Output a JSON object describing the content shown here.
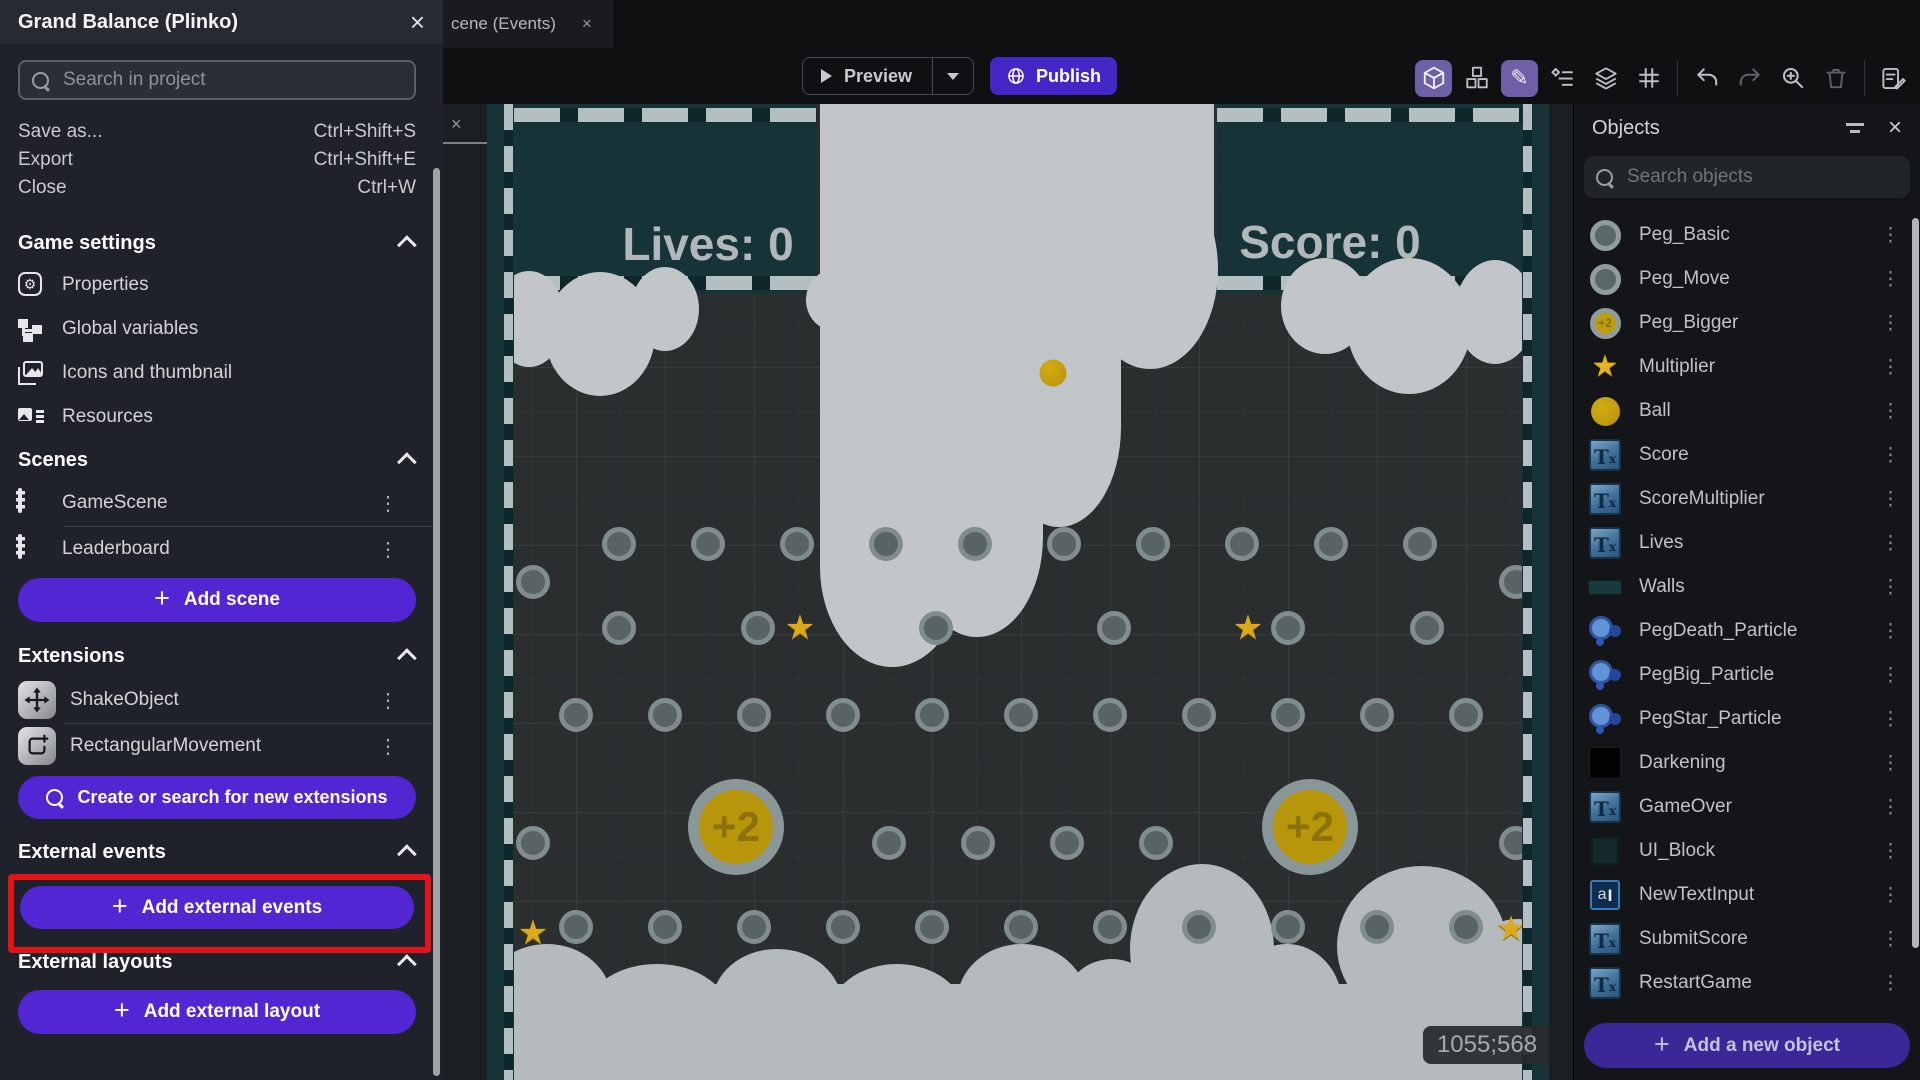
{
  "colors": {
    "accent_purple": "#5326d4",
    "publish_purple": "#4526c6",
    "highlight_red": "#e51414",
    "teal_block": "#163438",
    "gold": "#c9a40b",
    "cloud": "#c2c6c9"
  },
  "drawer": {
    "title": "Grand Balance (Plinko)",
    "close_icon": "×",
    "search_placeholder": "Search in project",
    "menu_items": [
      {
        "label": "Save as...",
        "shortcut": "Ctrl+Shift+S"
      },
      {
        "label": "Export",
        "shortcut": "Ctrl+Shift+E"
      },
      {
        "label": "Close",
        "shortcut": "Ctrl+W"
      }
    ],
    "game_settings": {
      "title": "Game settings",
      "items": [
        "Properties",
        "Global variables",
        "Icons and thumbnail",
        "Resources"
      ]
    },
    "scenes": {
      "title": "Scenes",
      "items": [
        "GameScene",
        "Leaderboard"
      ],
      "add_button": "Add scene"
    },
    "extensions": {
      "title": "Extensions",
      "items": [
        "ShakeObject",
        "RectangularMovement"
      ],
      "search_button": "Create or search for new extensions"
    },
    "external_events": {
      "title": "External events",
      "add_button": "Add external events"
    },
    "external_layouts": {
      "title": "External layouts",
      "add_button": "Add external layout"
    },
    "kebab_icon": "⋮"
  },
  "tab_bar": {
    "active_tab": "cene (Events)",
    "close_icon": "×"
  },
  "toolbar": {
    "preview_label": "Preview",
    "publish_label": "Publish"
  },
  "canvas": {
    "lives_text": "Lives: 0",
    "score_text": "Score: 0",
    "multiplier_text": "x25%",
    "cursor_coordinates": "1055;568",
    "scene": {
      "pegs": [
        [
          132,
          440
        ],
        [
          221,
          440
        ],
        [
          310,
          440
        ],
        [
          399,
          440
        ],
        [
          488,
          440
        ],
        [
          577,
          440
        ],
        [
          666,
          440
        ],
        [
          755,
          440
        ],
        [
          844,
          440
        ],
        [
          933,
          440
        ],
        [
          46,
          478
        ],
        [
          1029,
          478
        ],
        [
          132,
          524
        ],
        [
          271,
          524
        ],
        [
          449,
          524
        ],
        [
          627,
          524
        ],
        [
          801,
          524
        ],
        [
          940,
          524
        ],
        [
          89,
          611
        ],
        [
          178,
          611
        ],
        [
          267,
          611
        ],
        [
          356,
          611
        ],
        [
          445,
          611
        ],
        [
          534,
          611
        ],
        [
          623,
          611
        ],
        [
          712,
          611
        ],
        [
          801,
          611
        ],
        [
          890,
          611
        ],
        [
          979,
          611
        ],
        [
          46,
          739
        ],
        [
          402,
          739
        ],
        [
          491,
          739
        ],
        [
          580,
          739
        ],
        [
          669,
          739
        ],
        [
          1029,
          739
        ],
        [
          89,
          823
        ],
        [
          178,
          823
        ],
        [
          267,
          823
        ],
        [
          356,
          823
        ],
        [
          445,
          823
        ],
        [
          534,
          823
        ],
        [
          623,
          823
        ],
        [
          712,
          823
        ],
        [
          801,
          823
        ],
        [
          890,
          823
        ],
        [
          979,
          823
        ]
      ],
      "stars": [
        [
          313,
          524
        ],
        [
          761,
          524
        ],
        [
          46,
          829
        ],
        [
          1024,
          825
        ]
      ],
      "big_pegs": [
        {
          "x": 249,
          "y": 723,
          "label": "+2"
        },
        {
          "x": 823,
          "y": 723,
          "label": "+2"
        }
      ],
      "ball": [
        566,
        269
      ],
      "star_glyph": "★"
    }
  },
  "objects_panel": {
    "title": "Objects",
    "close_icon": "×",
    "search_placeholder": "Search objects",
    "add_button": "Add a new object",
    "kebab_icon": "⋮",
    "objects": [
      {
        "name": "Peg_Basic",
        "icon": "peg"
      },
      {
        "name": "Peg_Move",
        "icon": "peg"
      },
      {
        "name": "Peg_Bigger",
        "icon": "peg-bigger"
      },
      {
        "name": "Multiplier",
        "icon": "star"
      },
      {
        "name": "Ball",
        "icon": "ball"
      },
      {
        "name": "Score",
        "icon": "text"
      },
      {
        "name": "ScoreMultiplier",
        "icon": "text"
      },
      {
        "name": "Lives",
        "icon": "text"
      },
      {
        "name": "Walls",
        "icon": "wall"
      },
      {
        "name": "PegDeath_Particle",
        "icon": "particle"
      },
      {
        "name": "PegBig_Particle",
        "icon": "particle"
      },
      {
        "name": "PegStar_Particle",
        "icon": "particle"
      },
      {
        "name": "Darkening",
        "icon": "black"
      },
      {
        "name": "GameOver",
        "icon": "text"
      },
      {
        "name": "UI_Block",
        "icon": "block"
      },
      {
        "name": "NewTextInput",
        "icon": "input"
      },
      {
        "name": "SubmitScore",
        "icon": "text"
      },
      {
        "name": "RestartGame",
        "icon": "text"
      }
    ]
  }
}
